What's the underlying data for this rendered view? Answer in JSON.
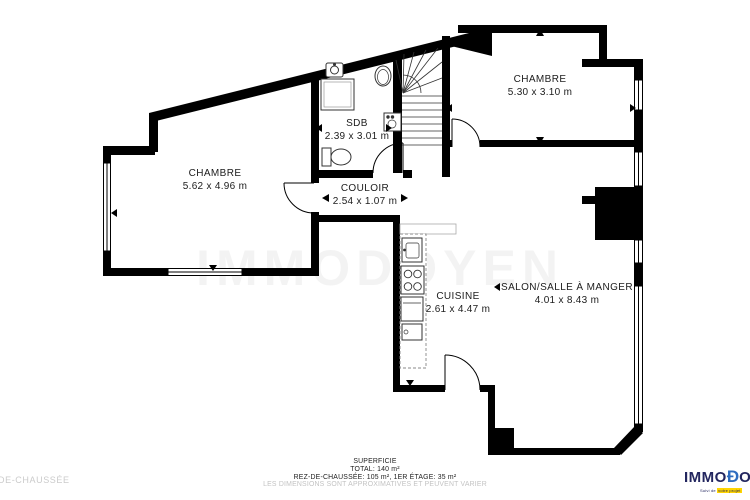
{
  "plan": {
    "watermark": "IMMODOYEN",
    "rooms": [
      {
        "id": "chambre-left",
        "name": "CHAMBRE",
        "dims": "5.62 x 4.96 m"
      },
      {
        "id": "chambre-top",
        "name": "CHAMBRE",
        "dims": "5.30 x 3.10 m"
      },
      {
        "id": "sdb",
        "name": "SDB",
        "dims": "2.39 x 3.01 m"
      },
      {
        "id": "couloir",
        "name": "COULOIR",
        "dims": "2.54 x 1.07 m"
      },
      {
        "id": "cuisine",
        "name": "CUISINE",
        "dims": "2.61 x 4.47 m"
      },
      {
        "id": "salon",
        "name": "SALON/SALLE À MANGER",
        "dims": "4.01 x 8.43 m"
      }
    ]
  },
  "footer": {
    "left_label": "DE-CHAUSSÉE",
    "superficie": "SUPERFICIE",
    "total": "TOTAL: 140 m²",
    "floors": "REZ-DE-CHAUSSÉE: 105 m², 1ER ÉTAGE: 35 m²",
    "disclaimer": "LES DIMENSIONS SONT APPROXIMATIVES ET PEUVENT VARIER"
  },
  "logo": {
    "text_before": "IMMO",
    "text_d": "Ɖ",
    "text_after": "OYEN",
    "tagline_1": "Suivi de",
    "tagline_2": "votre projet",
    "navy": "#23265f",
    "blue": "#2e6cc0",
    "yellow": "#ffd500"
  }
}
